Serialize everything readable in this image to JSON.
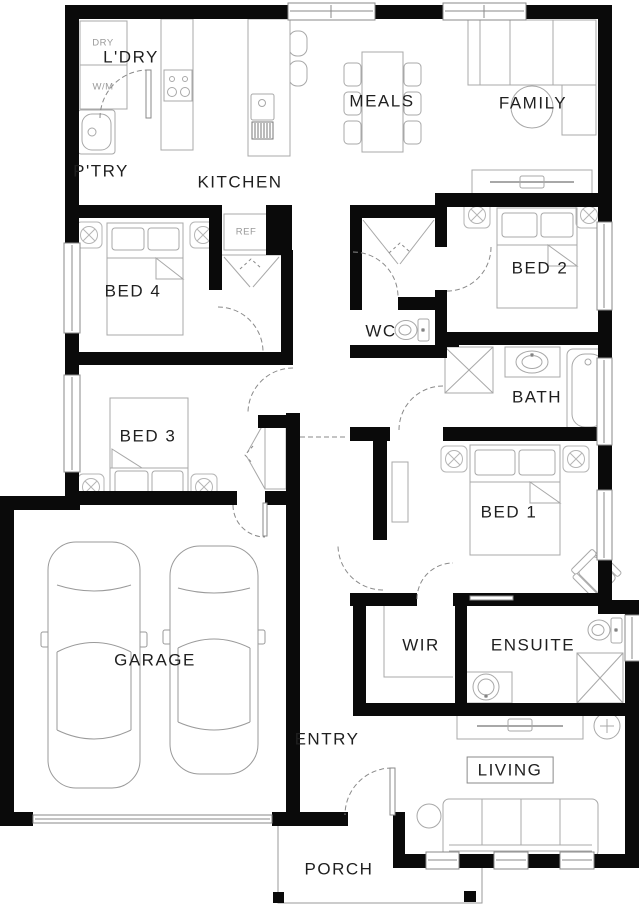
{
  "plan": {
    "rooms": {
      "ldry": "L'DRY",
      "ptry": "P'TRY",
      "kitchen": "KITCHEN",
      "meals": "MEALS",
      "family": "FAMILY",
      "bed4": "BED 4",
      "bed2": "BED 2",
      "wc": "WC",
      "bath": "BATH",
      "bed3": "BED 3",
      "bed1": "BED 1",
      "garage": "GARAGE",
      "wir": "WIR",
      "ensuite": "ENSUITE",
      "entry": "ENTRY",
      "living": "LIVING",
      "porch": "PORCH"
    },
    "fixtures": {
      "dryer": "DRY",
      "washer": "W/M",
      "fridge": "REF"
    },
    "colors": {
      "wall": "#0a0a0a",
      "furniture_line": "#a8a8a8",
      "door_line": "#8a8a8a",
      "label": "#1f1f1f",
      "fixture_label": "#9a9a9a",
      "background": "#ffffff"
    }
  }
}
